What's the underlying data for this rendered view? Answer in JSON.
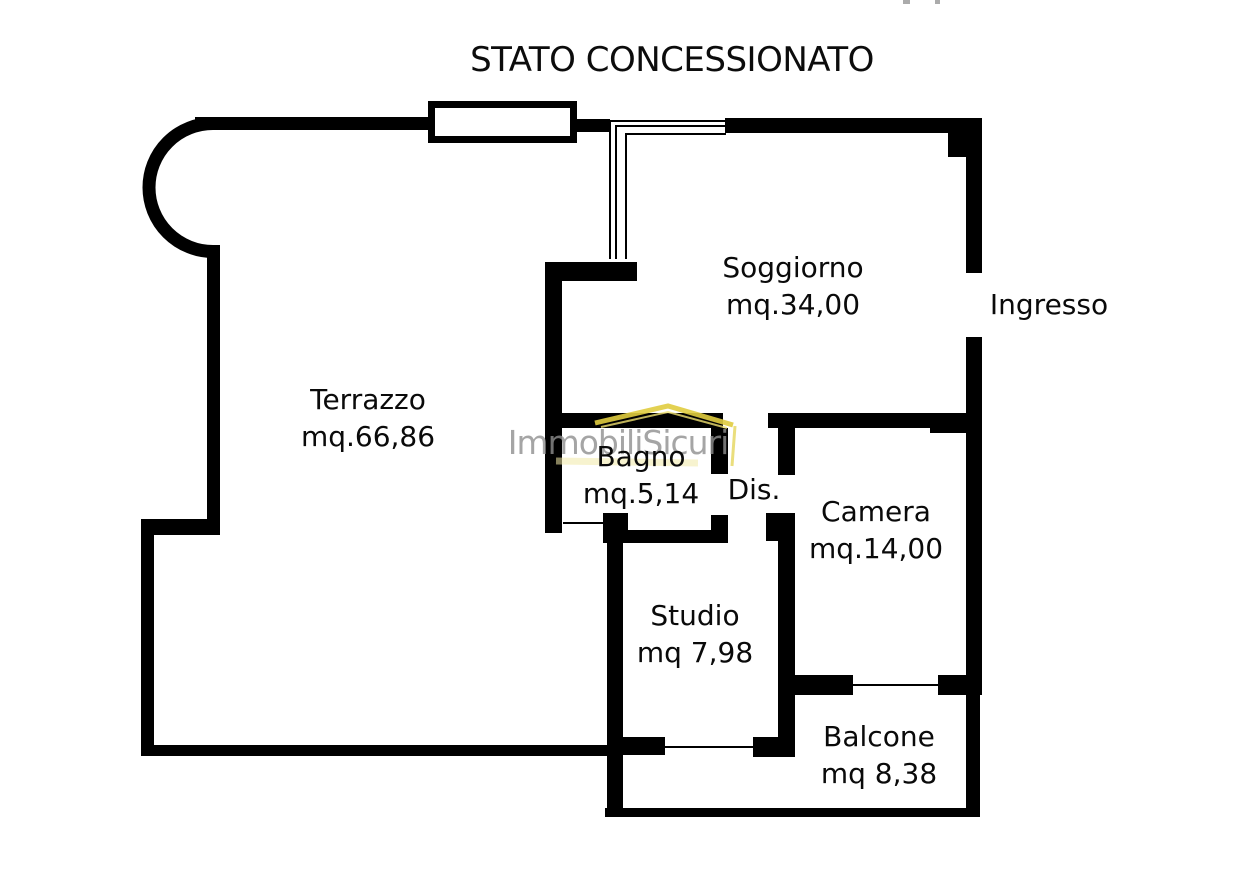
{
  "title": "STATO CONCESSIONATO",
  "watermark": {
    "text": "ImmobiliSicuri",
    "text_color": "#8f8f8f",
    "roof_color": "#e3cf45"
  },
  "colors": {
    "walls": "#000000",
    "background": "#ffffff"
  },
  "rooms": [
    {
      "name": "Terrazzo",
      "area": "mq.66,86"
    },
    {
      "name": "Soggiorno",
      "area": "mq.34,00"
    },
    {
      "name": "Ingresso",
      "area": ""
    },
    {
      "name": "Bagno",
      "area": "mq.5,14"
    },
    {
      "name": "Dis.",
      "area": ""
    },
    {
      "name": "Camera",
      "area": "mq.14,00"
    },
    {
      "name": "Studio",
      "area": "mq 7,98"
    },
    {
      "name": "Balcone",
      "area": "mq 8,38"
    }
  ]
}
